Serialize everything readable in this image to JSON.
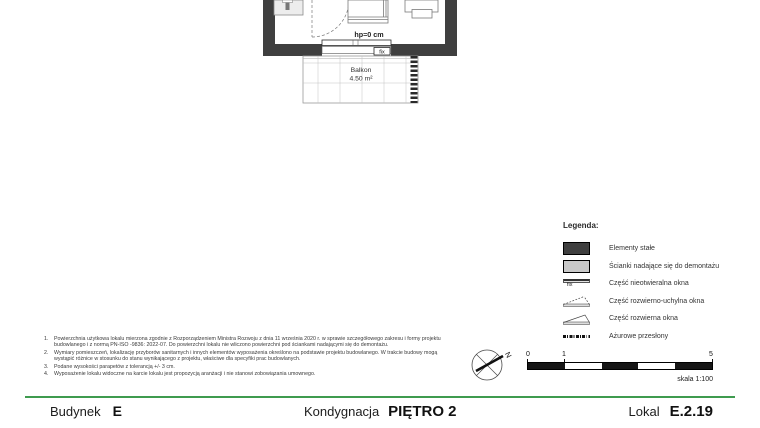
{
  "plan": {
    "hp_label": "hp=0 cm",
    "window_fix_label": "fix",
    "balcony_name": "Balkon",
    "balcony_area": "4.50 m²"
  },
  "legend": {
    "title": "Legenda:",
    "items": [
      {
        "symbol": "fixed-elements-swatch",
        "label": "Elementy stałe"
      },
      {
        "symbol": "demountable-wall-swatch",
        "label": "Ścianki nadające się do demontażu"
      },
      {
        "symbol": "fixed-window-symbol",
        "symbol_text": "fix",
        "label": "Część nieotwieralna okna"
      },
      {
        "symbol": "tilt-turn-window-symbol",
        "label": "Część rozwierno-uchylna okna"
      },
      {
        "symbol": "side-hung-window-symbol",
        "label": "Część rozwierna okna"
      },
      {
        "symbol": "openwork-screen-symbol",
        "label": "Ażurowe przesłony"
      }
    ]
  },
  "notes": [
    {
      "num": "1.",
      "text": "Powierzchnia użytkowa lokalu mierzona zgodnie z Rozporządzeniem Ministra Rozwoju z dnia 11 września 2020 r. w sprawie szczegółowego zakresu i formy projektu budowlanego i z normą PN-ISO -9836: 2022-07. Do powierzchni lokalu nie wliczono powierzchni pod ściankami nadającymi się do demontażu."
    },
    {
      "num": "2.",
      "text": "Wymiary pomieszczeń, lokalizację przyborów sanitarnych i innych elementów wyposażenia określono na podstawie projektu budowlanego. W trakcie budowy mogą wystąpić różnice w stosunku do stanu wynikającego z projektu, właściwe dla specyfiki prac budowlanych."
    },
    {
      "num": "3.",
      "text": "Podane wysokości parapetów z tolerancją +/- 3 cm."
    },
    {
      "num": "4.",
      "text": "Wyposażenie lokalu widoczne na karcie lokalu jest propozycją aranżacji i nie stanowi zobowiązania umownego."
    }
  ],
  "compass": {
    "north_label": "N"
  },
  "scale_bar": {
    "tick_0": "0",
    "tick_1": "1",
    "tick_5": "5",
    "caption": "skala 1:100"
  },
  "footer": {
    "building_label": "Budynek",
    "building_value": "E",
    "floor_label": "Kondygnacja",
    "floor_value": "PIĘTRO 2",
    "unit_label": "Lokal",
    "unit_value": "E.2.19"
  },
  "colors": {
    "fixed_elements": "#3f3f3f",
    "demountable_walls": "#c9c9c9",
    "footer_accent_green": "#3f9b4f"
  }
}
